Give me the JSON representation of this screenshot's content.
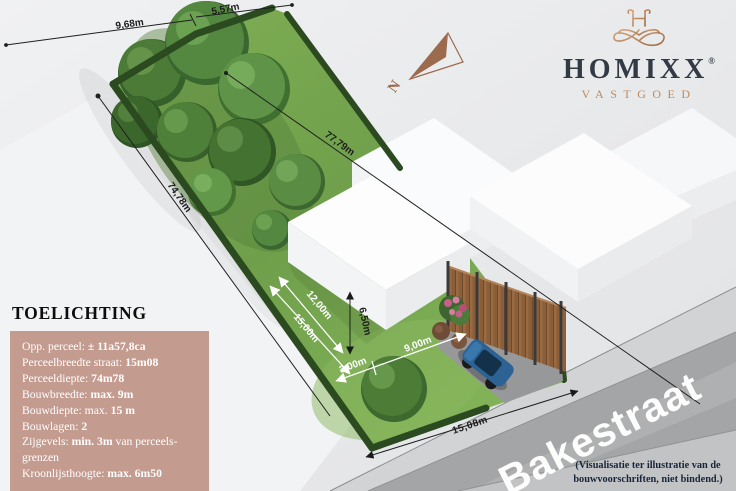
{
  "header": {
    "logo": {
      "brand": "HOMIXX",
      "registered": "®",
      "subtitle": "VASTGOED"
    }
  },
  "compass": {
    "label": "N"
  },
  "dimensions": {
    "rear_segment_left": "9,68m",
    "rear_segment_right": "5,57m",
    "parcel_depth_left": "74,78m",
    "parcel_diagonal": "77,79m",
    "build_depth_a": "12,00m",
    "build_depth_b": "15,00m",
    "cornice_height": "6,50m",
    "side_setback": "3,00m",
    "build_width": "9,00m",
    "street_frontage": "15,08m"
  },
  "street": {
    "name": "Bakestraat"
  },
  "disclaimer": {
    "line1": "(Visualisatie ter illustratie van de",
    "line2": "bouwvoorschriften, niet bindend.)"
  },
  "panel": {
    "title": "TOELICHTING",
    "lines": [
      {
        "label": "Opp. perceel:",
        "value": "± 11a57,8ca",
        "suffix": ""
      },
      {
        "label": "Perceelbreedte straat:",
        "value": "15m08",
        "suffix": ""
      },
      {
        "label": "Perceeldiepte:",
        "value": "74m78",
        "suffix": ""
      },
      {
        "label": "Bouwbreedte:",
        "value": "max. 9m",
        "suffix": ""
      },
      {
        "label": "Bouwdiepte: max.",
        "value": "15 m",
        "suffix": ""
      },
      {
        "label": "Bouwlagen:",
        "value": "2",
        "suffix": ""
      },
      {
        "label": "Zijgevels:",
        "value": "min. 3m",
        "suffix": "van perceels-grenzen"
      },
      {
        "label": "Kroonlijsthoogte:",
        "value": "max. 6m50",
        "suffix": ""
      }
    ]
  },
  "colors": {
    "brand_dark": "#323a46",
    "brand_copper": "#bb8a60",
    "panel_bg": "#c49b8f",
    "grass": "#75a24c",
    "hedge": "#2c4a20",
    "road": "#a4a5a7",
    "fence_wood": "#9a6b42",
    "car_blue": "#2c6394",
    "dimension_text": "#1d1d1d"
  }
}
